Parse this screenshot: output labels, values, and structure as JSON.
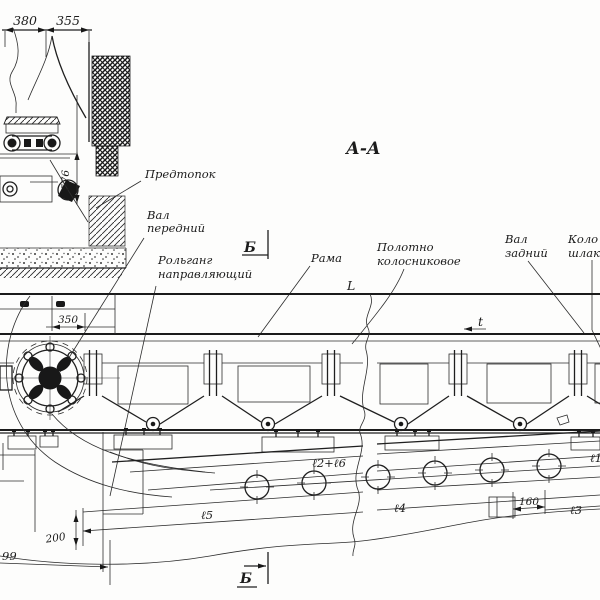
{
  "drawing": {
    "section_title": "А-А",
    "labels": {
      "predtopok": "Предтопок",
      "val_front_1": "Вал",
      "val_front_2": "передний",
      "rolgang_1": "Рольганг",
      "rolgang_2": "направляющий",
      "rama": "Рама",
      "polotno_1": "Полотно",
      "polotno_2": "колосниковое",
      "val_rear_1": "Вал",
      "val_rear_2": "задний",
      "kolos_1": "Коло",
      "kolos_2": "шлак"
    },
    "dimensions": {
      "d380": "380",
      "d355": "355",
      "d576": "576",
      "d350": "350",
      "d200": "200",
      "d99": "99",
      "d160": "160",
      "L_top": "L",
      "t_small": "t",
      "l5": "ℓ5",
      "l4": "ℓ4",
      "l2l6": "ℓ2+ℓ6",
      "l3": "ℓ3",
      "l1": "ℓ1"
    },
    "section_markers": {
      "b_top": "Б",
      "b_bottom": "Б"
    },
    "colors": {
      "ink": "#1b1b1b",
      "paper": "#fdfdfc"
    }
  }
}
